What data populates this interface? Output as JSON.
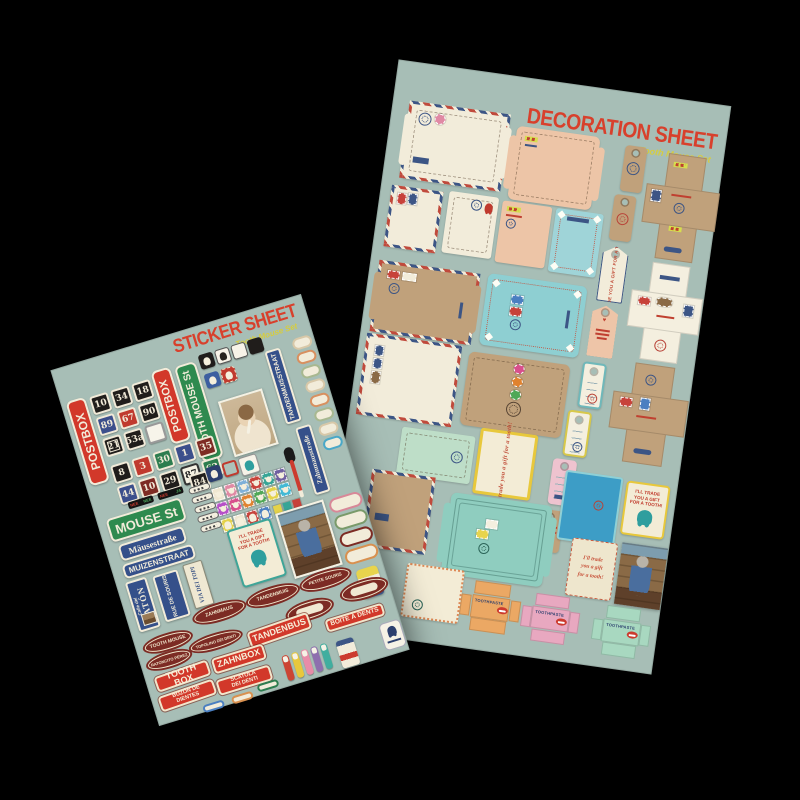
{
  "colors": {
    "sheet": "#a7beb6",
    "title": "#d8402c",
    "subtitle": "#d7cd3e",
    "cream": "#f2ecda",
    "kraft": "#c0a17b",
    "peach": "#edc5a7",
    "teal": "#8ecfd2",
    "mint": "#bedec8",
    "navy": "#35508a",
    "green": "#2e8a4f",
    "red": "#d2382a",
    "darkred": "#7c2b24",
    "bluecard": "#3d9dc6"
  },
  "sticker_sheet": {
    "title": "STICKER SHEET",
    "subtitle": "Tooth Mouse Set",
    "postbox": "POSTBOX",
    "tooth_mouse_st": "TOOTH MOUSE St",
    "tandenmuisstraat": "TANDENMUISSTRAAT",
    "zahnmausstrasse": "Zahnmausstraße",
    "mouse_st": "MOUSE St",
    "mausestrasse": "Mäusestraße",
    "muizenstraat": "MUIZENSTRAAT",
    "calle_del": "Calle del",
    "raton": "RATÓN",
    "rue_de_souris": "RUE\nDE\nSOURIS",
    "via_dei_topi": "VIA DEI TOPI",
    "trade_card": "I'LL TRADE\nYOU A GIFT\nFOR A TOOTH!",
    "plates_a": [
      {
        "label": "10",
        "style": "black"
      },
      {
        "label": "34",
        "style": "black"
      },
      {
        "label": "18",
        "style": "black"
      },
      {
        "label": "89",
        "style": "blue"
      },
      {
        "label": "67",
        "style": "red"
      },
      {
        "label": "90",
        "style": "black"
      },
      {
        "label": "21",
        "style": "framed"
      },
      {
        "label": "53a",
        "style": "black"
      },
      {
        "label": "",
        "style": "whiteblank"
      }
    ],
    "plates_b": [
      {
        "label": "8",
        "style": "black"
      },
      {
        "label": "3",
        "style": "red"
      },
      {
        "label": "30",
        "style": "green"
      },
      {
        "label": "1",
        "style": "blue"
      },
      {
        "label": "35",
        "style": "darkred"
      },
      {
        "label": "44",
        "style": "blue"
      },
      {
        "label": "10",
        "style": "darkred"
      },
      {
        "label": "29",
        "style": "black"
      },
      {
        "label": "87",
        "style": "white"
      },
      {
        "label": "62",
        "style": "green"
      }
    ],
    "plate_84": "84",
    "nee_strips": [
      {
        "l": "NEE",
        "r": "NEE"
      },
      {
        "l": "NEE",
        "r": "JA"
      }
    ],
    "mouse_stamps": [
      "#efe7d1",
      "#e089a4",
      "#7fb0d8",
      "#c7423a",
      "#37a596",
      "#6f5fa0",
      "#b64fc8",
      "#d84f8c",
      "#e0822f",
      "#4fa857",
      "#e4d24a",
      "#42b9d5"
    ],
    "tooth_stamps": [
      "#e4d24a",
      "#efe7d1",
      "#c7423a",
      "#4a7fc1"
    ],
    "mini_squares": [
      "#e4d24a",
      "#37a596",
      "#c7423a"
    ],
    "right_pills": [
      "#d8c8a8",
      "#d89060",
      "#a8b890",
      "#d8c8a8",
      "#d89060",
      "#a8b890",
      "#d8c8a8",
      "#4aa8c8"
    ],
    "blank_ovals": [
      "#d88898",
      "#7a9a6a",
      "#7c2b24",
      "#d8904f"
    ],
    "brush_colors": [
      "#cc4433",
      "#e8c83c",
      "#e88ca8",
      "#8e6fae",
      "#3fae9f"
    ],
    "plaques": {
      "zahnmaus": "ZAHNMAUS",
      "tandenmuis": "TANDENMUIS",
      "petite_souris": "PETITE SOURIS",
      "tooth_mouse": "TOOTH MOUSE",
      "topolino": "TOPOLINO DEI DENTI",
      "ratoncito": "RATONCITO PÉREZ"
    },
    "boxes": {
      "tandenbus": "TANDENBUS",
      "boite": "BOÎTE À DENTS",
      "zahnbox": "ZAHNBOX",
      "tooth_box": "TOOTH BOX",
      "scatola": "SCATOLA\nDEI DENTI",
      "buzon": "BUZÓN DE\nDIENTES"
    }
  },
  "decoration_sheet": {
    "title": "DECORATION SHEET",
    "subtitle": "Tooth Mouse Set",
    "trade_tag": "I'LL TRADE YOU A GIFT FOR A TOOTH",
    "trade_card": "I'LL TRADE\nYOU A GIFT\nFOR A TOOTH!",
    "trade_script": "I'll trade\nyou a gift\nfor a tooth!",
    "toothpaste": "TOOTHPASTE"
  }
}
